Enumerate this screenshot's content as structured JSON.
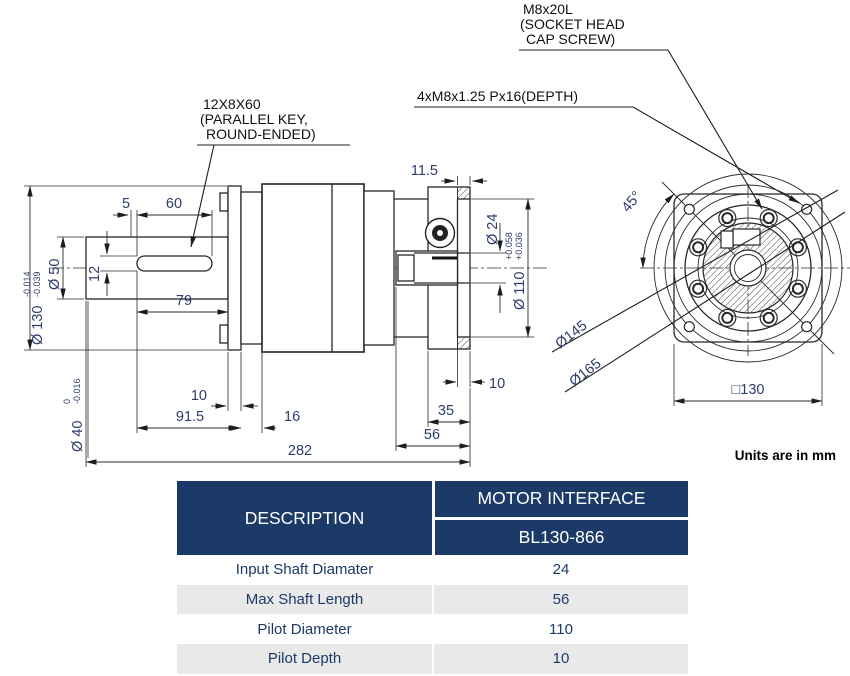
{
  "drawing": {
    "notes": {
      "key_note_l1": "12X8X60",
      "key_note_l2": "(PARALLEL KEY,",
      "key_note_l3": "ROUND-ENDED)",
      "screw_note_l1": "M8x20L",
      "screw_note_l2": "(SOCKET HEAD",
      "screw_note_l3": "CAP SCREW)",
      "tap_note": "4xM8x1.25 Px16(DEPTH)",
      "units_note": "Units are in mm"
    },
    "dims": {
      "d5": "5",
      "d60": "60",
      "d12": "12",
      "d79": "79",
      "d10_flange": "10",
      "d91_5": "91.5",
      "d16": "16",
      "d282": "282",
      "d11_5": "11.5",
      "d35": "35",
      "d56": "56",
      "d10_pilot": "10",
      "dia50": "Ø 50",
      "dia130": "Ø 130",
      "dia130_tol_u": "-0.014",
      "dia130_tol_l": "-0.039",
      "dia40": "Ø 40",
      "dia40_tol_u": "0",
      "dia40_tol_l": "-0.016",
      "dia24": "Ø 24",
      "dia110": "Ø 110",
      "dia110_tol_u": "+0.058",
      "dia110_tol_l": "+0.036",
      "deg45": "45°",
      "dia145": "Ø145",
      "dia165": "Ø165",
      "sq130": "□130"
    },
    "colors": {
      "line": "#262626",
      "dim_text": "#2d3c6b"
    }
  },
  "table": {
    "col1_header": "DESCRIPTION",
    "col2_header": "MOTOR INTERFACE",
    "col2_subheader": "BL130-866",
    "rows": [
      {
        "label": "Input Shaft Diamater",
        "value": "24"
      },
      {
        "label": "Max Shaft Length",
        "value": "56"
      },
      {
        "label": "Pilot Diameter",
        "value": "110"
      },
      {
        "label": "Pilot Depth",
        "value": "10"
      }
    ],
    "colors": {
      "header_bg": "#1b3a67",
      "row_alt_bg": "#e9e9e9",
      "text": "#1b3a67"
    }
  }
}
